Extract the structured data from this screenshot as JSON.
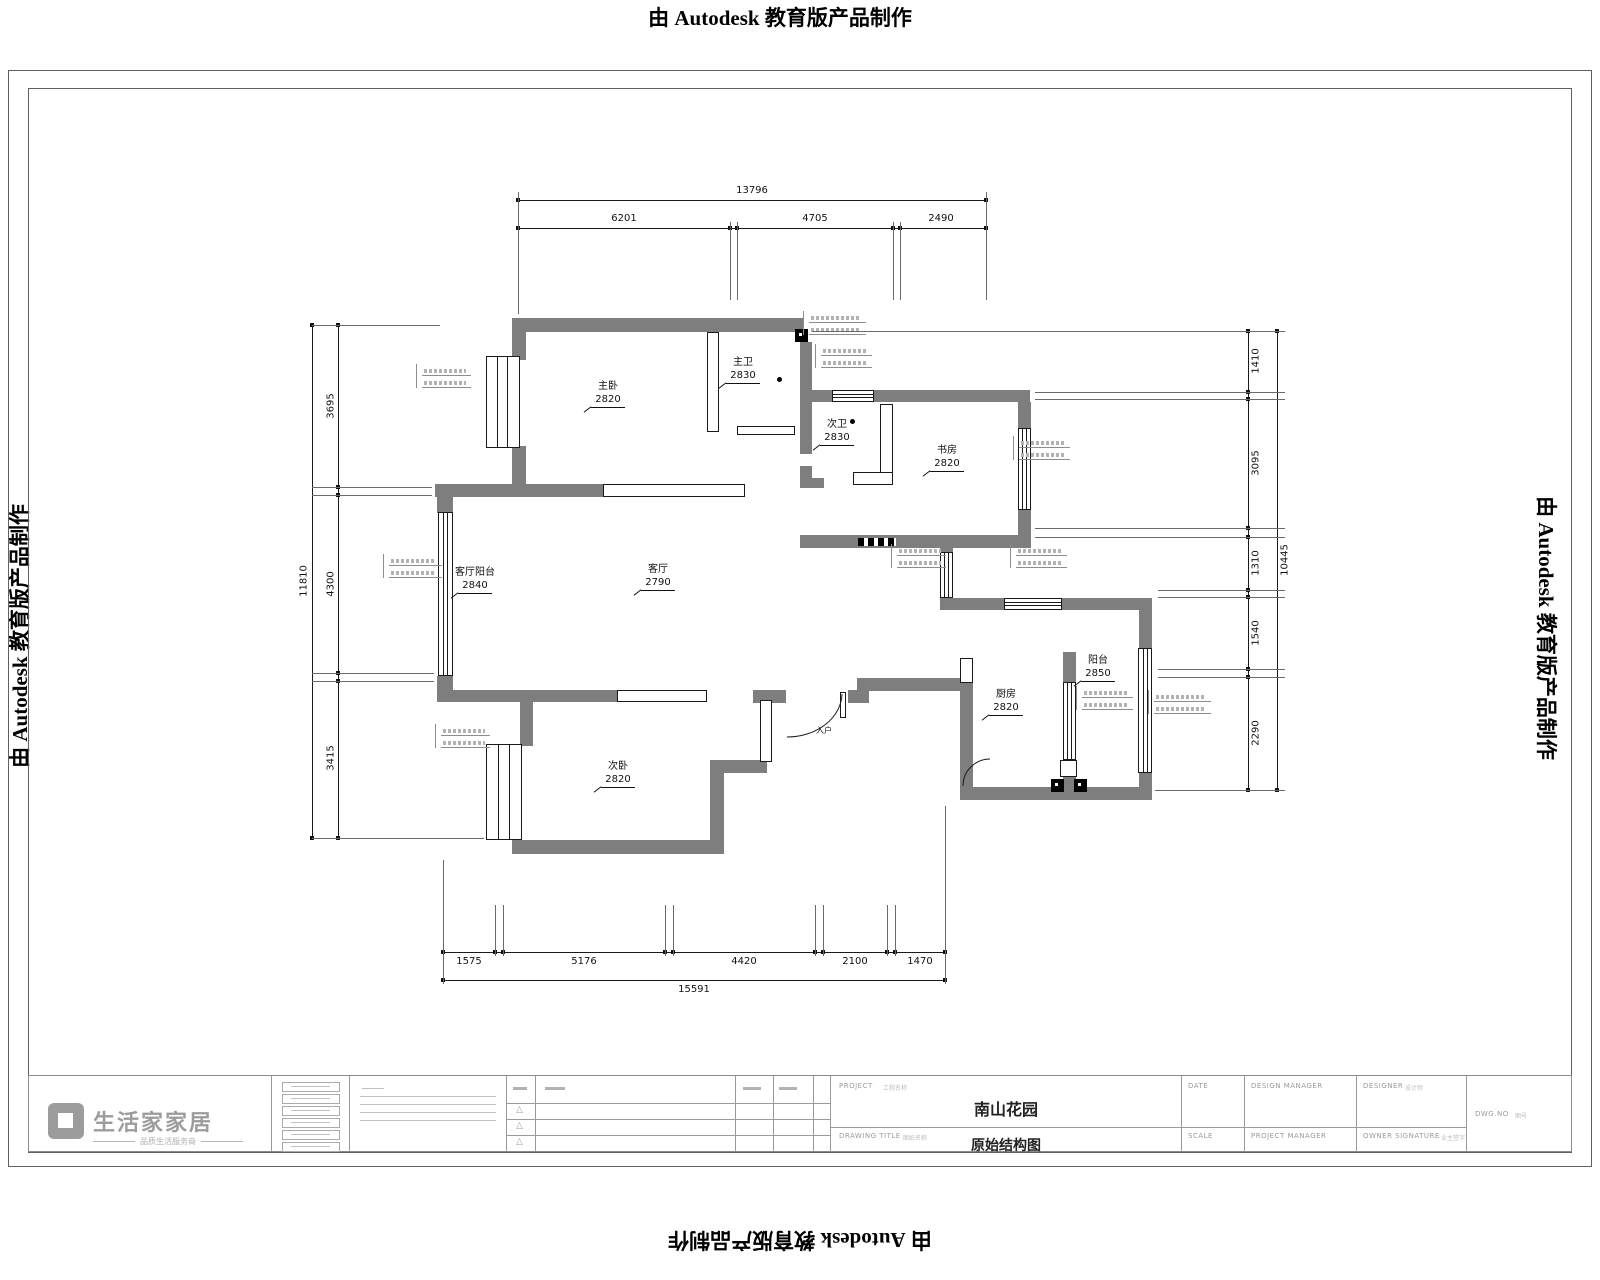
{
  "banner": {
    "text": "由 Autodesk 教育版产品制作"
  },
  "plan": {
    "rooms": [
      {
        "name": "主卧",
        "size": "2820"
      },
      {
        "name": "主卫",
        "size": "2830"
      },
      {
        "name": "次卫",
        "size": "2830"
      },
      {
        "name": "书房",
        "size": "2820"
      },
      {
        "name": "客厅阳台",
        "size": "2840"
      },
      {
        "name": "客厅",
        "size": "2790"
      },
      {
        "name": "次卧",
        "size": "2820"
      },
      {
        "name": "厨房",
        "size": "2820"
      },
      {
        "name": "阳台",
        "size": "2850"
      },
      {
        "name": "入户",
        "size": ""
      }
    ],
    "dimensions": {
      "top": {
        "overall": "13796",
        "segments": [
          "6201",
          "4705",
          "2490"
        ]
      },
      "bottom": {
        "overall": "15591",
        "segments": [
          "1575",
          "5176",
          "4420",
          "2100",
          "1470"
        ]
      },
      "left": {
        "overall": "11810",
        "segments": [
          "3695",
          "4300",
          "3415"
        ]
      },
      "right": {
        "overall": "10445",
        "segments": [
          "1410",
          "3095",
          "1310",
          "1540",
          "2290"
        ]
      }
    }
  },
  "title_block": {
    "logo": {
      "brand": "生活家家居",
      "tagline": "品质生活服务商"
    },
    "project_label": "PROJECT",
    "project_label_cn": "工程名称",
    "project_name": "南山花园",
    "drawing_title_label": "DRAWING TITLE",
    "drawing_title_label_cn": "图纸名称",
    "drawing_title": "原始结构图",
    "date_label": "DATE",
    "scale_label": "SCALE",
    "design_manager_label": "DESIGN MANAGER",
    "project_manager_label": "PROJECT MANAGER",
    "designer_label": "DESIGNER",
    "designer_label_cn": "设计师",
    "owner_label": "OWNER SIGNATURE",
    "owner_label_cn": "业主签字",
    "dwg_label": "DWG.NO",
    "dwg_label_cn": "图号"
  }
}
